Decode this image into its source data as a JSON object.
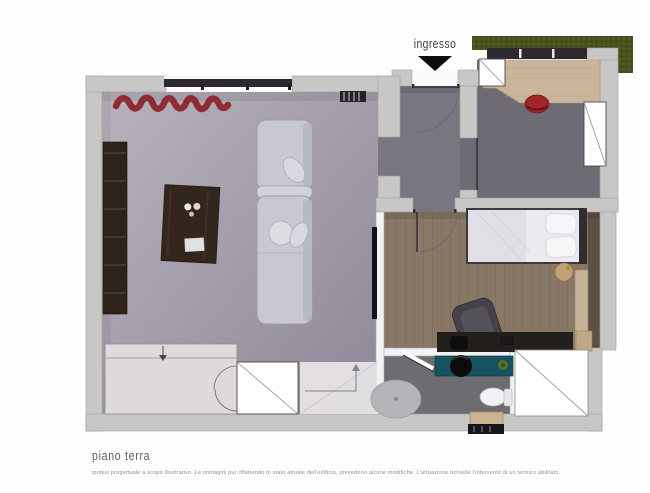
{
  "plan": {
    "entrance_label": "ingresso",
    "title": "piano terra",
    "disclaimer": "ipotesi progettuale a scopo illustrativo. Le immagini pur riflettendo lo stato attuale dell'edificio, prevedono alcune modifiche. L'attuazione richiede l'intervento di un tecnico abilitato."
  },
  "palette": {
    "page_bg": "#fdfdfd",
    "wall": "#c7c8c6",
    "wall_line": "#9fa19f",
    "living_floor_a": "#b8b2bd",
    "living_floor_b": "#8e8896",
    "hall_floor": "#7a7680",
    "study_floor": "#6f6b74",
    "wood_floor": "#8a7866",
    "wood_line": "#776754",
    "bath_floor": "#6e6b71",
    "hedge_green": "#4b511e",
    "desk_wood": "#c8b59a",
    "dark_wood": "#2e231b",
    "accent_red": "#8e2c33",
    "chair_red": "#a3242b",
    "sofa_gray": "#c8c8d2",
    "sofa_edge": "#9d9daa",
    "vanity_teal": "#175260",
    "ink": "#0c0c0c",
    "title_gray": "#5f5f5f",
    "note_gray": "#8f8f8f"
  }
}
